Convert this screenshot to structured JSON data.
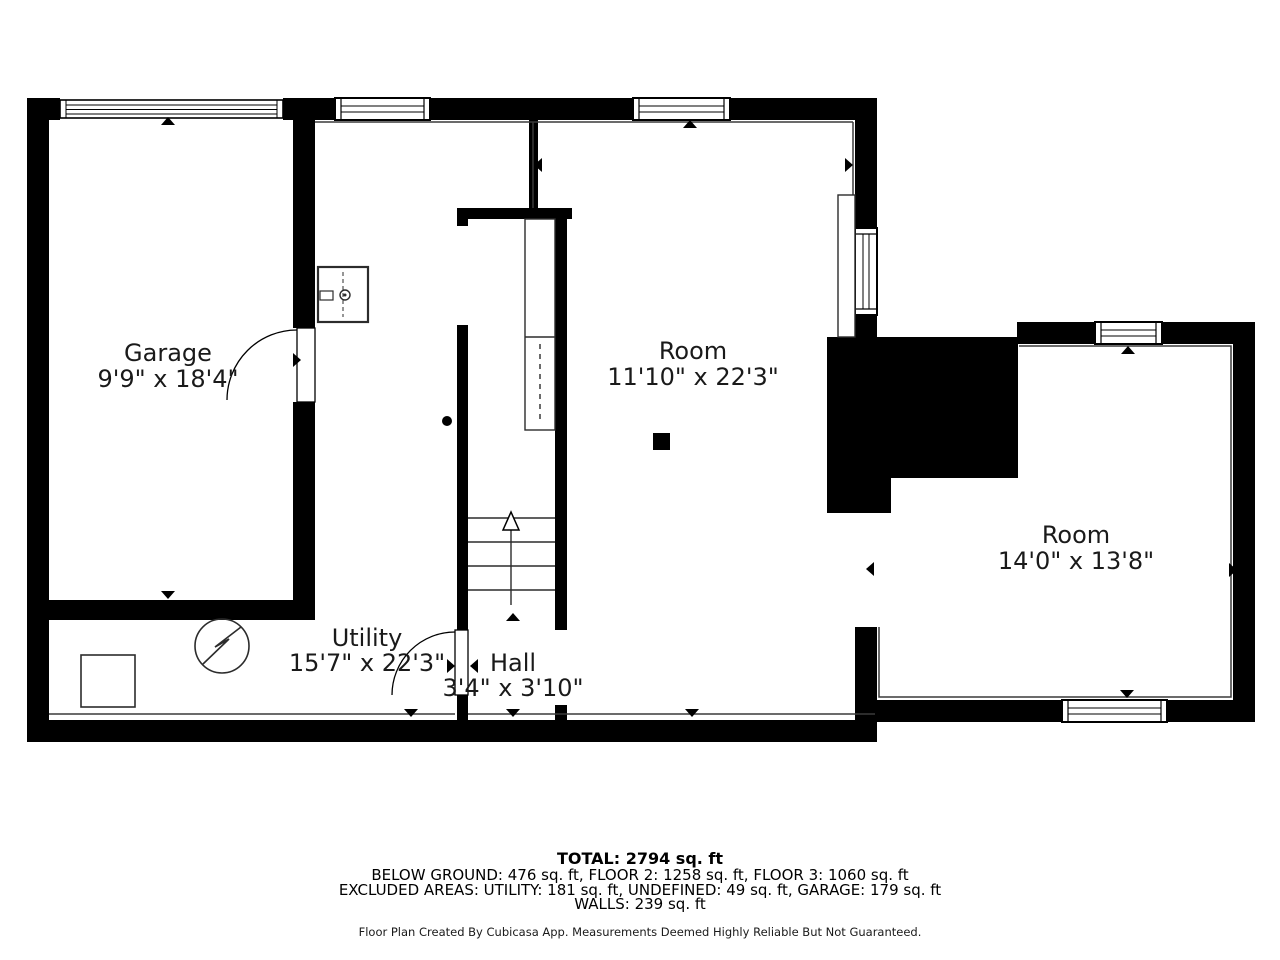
{
  "plan": {
    "rooms": {
      "garage": {
        "name": "Garage",
        "dims": "9'9\" x 18'4\""
      },
      "utility": {
        "name": "Utility",
        "dims": "15'7\" x 22'3\""
      },
      "hall": {
        "name": "Hall",
        "dims": "3'4\" x 3'10\""
      },
      "room1": {
        "name": "Room",
        "dims": "11'10\" x 22'3\""
      },
      "room2": {
        "name": "Room",
        "dims": "14'0\" x 13'8\""
      }
    },
    "colors": {
      "wall": "#000000",
      "background": "#ffffff",
      "thin_line": "#3a3a3a"
    }
  },
  "footer": {
    "total": "TOTAL: 2794 sq. ft",
    "line1": "BELOW GROUND: 476 sq. ft, FLOOR 2: 1258 sq. ft, FLOOR 3: 1060 sq. ft",
    "line2": "EXCLUDED AREAS: UTILITY: 181 sq. ft, UNDEFINED: 49 sq. ft, GARAGE: 179 sq. ft",
    "line3": "WALLS: 239 sq. ft",
    "disclaimer": "Floor Plan Created By Cubicasa App. Measurements Deemed Highly Reliable But Not Guaranteed."
  }
}
